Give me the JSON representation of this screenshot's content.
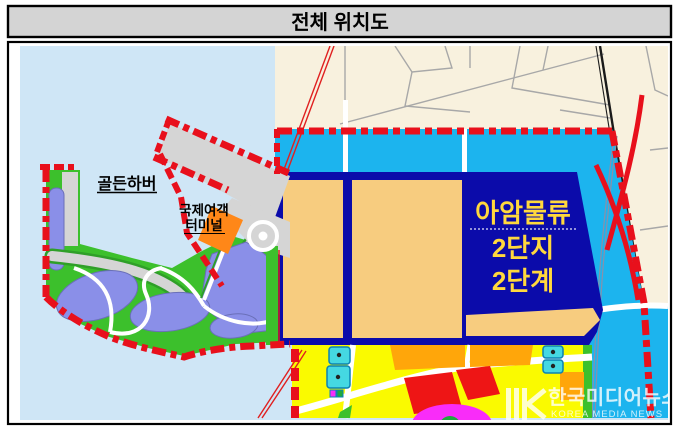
{
  "header": {
    "title": "전체 위치도"
  },
  "map": {
    "labels": {
      "golden_harbor": "골든하버",
      "terminal_line1": "국제여객",
      "terminal_line2": "터미널",
      "logistics_line1": "아암물류",
      "logistics_line2": "2단지",
      "logistics_line3": "2단계"
    },
    "colors": {
      "header_bg": "#d4d4d4",
      "sea": "#cfe6f6",
      "land_cream": "#f8f1de",
      "reserve_cyan": "#1cb4ee",
      "complex_navy": "#0b0baa",
      "parcel_tan": "#f7cc7f",
      "label_yellow": "#ffd83d",
      "urban_yellow": "#fafa00",
      "block_orange": "#ffa60a",
      "block_red": "#ee1515",
      "block_magenta": "#f92cf9",
      "block_cyan": "#45d8e2",
      "pond_purple": "#8a8fe8",
      "park_green": "#3cc02c",
      "land_gray": "#d5d5d5",
      "terminal_orange": "#ff8718",
      "boundary_red": "#e8101c"
    }
  },
  "watermark": {
    "title": "한국미디어뉴스",
    "subtitle": "KOREA MEDIA NEWS"
  }
}
